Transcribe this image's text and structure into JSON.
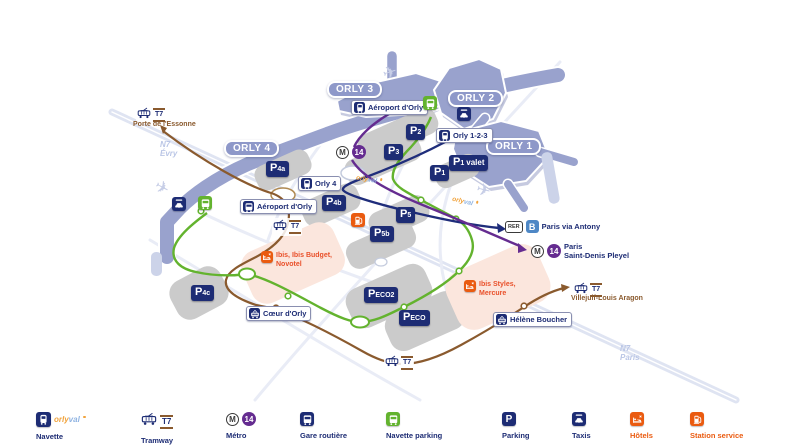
{
  "colors": {
    "navy": "#1d2c74",
    "periwinkle": "#99a2cd",
    "green": "#63b32e",
    "purple": "#652c90",
    "brown": "#8a5a2e",
    "orange": "#ea5b10",
    "rer_b_blue": "#4e87c5",
    "parking_gray": "#cbcbcb",
    "hotel_pink": "#fbe6dd",
    "road_pale": "#dfe4f2"
  },
  "map": {
    "terminals": [
      {
        "label": "ORLY 4"
      },
      {
        "label": "ORLY 3"
      },
      {
        "label": "ORLY 2"
      },
      {
        "label": "ORLY 1"
      }
    ],
    "stations": [
      {
        "label": "Aéroport d'Orly"
      },
      {
        "label": "Orly 1-2-3"
      },
      {
        "label": "Orly 4"
      },
      {
        "label": "Aéroport d'Orly"
      },
      {
        "label": "Cœur d'Orly"
      },
      {
        "label": "Hélène Boucher"
      }
    ],
    "parkings": [
      {
        "p": "P",
        "sub": "4a"
      },
      {
        "p": "P",
        "sub": "2"
      },
      {
        "p": "P",
        "sub": "3"
      },
      {
        "p": "P",
        "sub": "1",
        "extra": "valet"
      },
      {
        "p": "P",
        "sub": "1"
      },
      {
        "p": "P",
        "sub": "4b"
      },
      {
        "p": "P",
        "sub": "5"
      },
      {
        "p": "P",
        "sub": "5b"
      },
      {
        "p": "P",
        "sub": "4c"
      },
      {
        "p": "P",
        "sub": "ECO2"
      },
      {
        "p": "P",
        "sub": "ECO"
      }
    ],
    "tram": {
      "t7": "T7",
      "porte_essonne": "Porte de l'Essonne",
      "villejuif": "Villejuif-Louis Aragon"
    },
    "metro": {
      "m": "M",
      "line": "14",
      "dest_line1": "Paris",
      "dest_line2": "Saint-Denis Pleyel"
    },
    "rer": {
      "badge": "RER",
      "line": "B",
      "dest": "Paris via Antony"
    },
    "hotels": {
      "west_line1": "Ibis, Ibis Budget,",
      "west_line2": "Novotel",
      "east_line1": "Ibis Styles,",
      "east_line2": "Mercure"
    },
    "roads": {
      "evry_road": "N7",
      "evry_city": "Évry",
      "paris_road": "N7",
      "paris_city": "Paris"
    },
    "orlyval": {
      "part1": "orly",
      "part2": "val"
    }
  },
  "legend": {
    "parking_glyph": "P",
    "items": [
      {
        "label": "Navette"
      },
      {
        "label": "Tramway"
      },
      {
        "label": "Métro"
      },
      {
        "label": "Gare routière"
      },
      {
        "label": "Navette parking"
      },
      {
        "label": "Parking"
      },
      {
        "label": "Taxis"
      },
      {
        "label": "Hôtels"
      },
      {
        "label": "Station service"
      }
    ]
  }
}
